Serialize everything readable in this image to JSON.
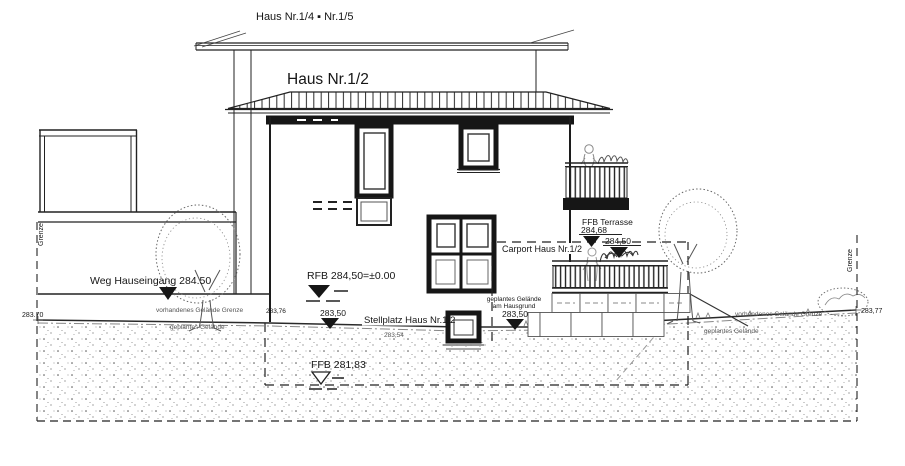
{
  "drawing_type": "site elevation / Ansicht",
  "colors": {
    "line": "#1c1c1c",
    "dark_fill": "#161616",
    "sketch_grey": "#777777",
    "stipple_grey": "#666666",
    "background": "#ffffff"
  },
  "labels": {
    "rear_house": "Haus Nr.1/4 ▪ Nr.1/5",
    "main_house": "Haus Nr.1/2",
    "weg_hauseingang": "Weg Hauseingang 284.50",
    "rfb": "RFB 284,50=±0.00",
    "ffb_keller": "FFB 281,83",
    "ffb_terrasse": "FFB Terrasse",
    "ffb_terrasse_level": "284,68",
    "terrasse_level2": "284,50",
    "carport": "Carport Haus Nr.1/2",
    "stellplatz": "Stellplatz Haus Nr.1/2",
    "stellplatz_level": "283,50",
    "stellplatz_sub": "283,54",
    "hausgrund_l1": "geplantes Gelände",
    "hausgrund_l2": "am Hausgrund",
    "hausgrund_level": "283,50",
    "level_left": "283.70",
    "level_mid": "283,76",
    "level_right": "283,77",
    "grenze_left": "Grenze",
    "grenze_right": "Grenze",
    "vorh_left": "vorhandenes Gelände Grenze",
    "gepl_left": "geplantes Gelände",
    "vorh_right": "vorhandenes Gelände Grenze",
    "gepl_right": "geplantes Gelände"
  }
}
